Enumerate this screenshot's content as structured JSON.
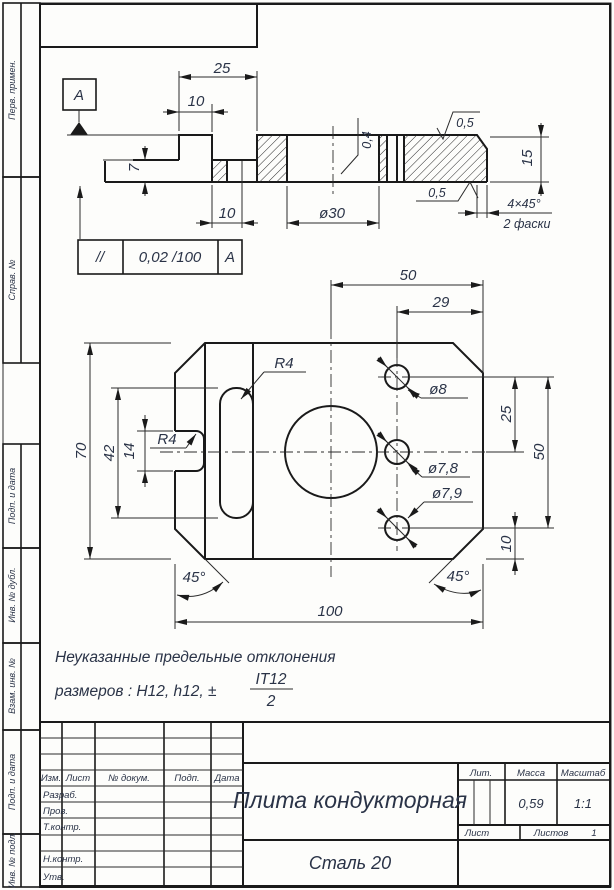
{
  "margin": {
    "labels": {
      "b1": "Перв. примен.",
      "b2": "Справ. №",
      "b3": "Подп. и дата",
      "b4": "Инв. № дубл.",
      "b5": "Взам. инв. №",
      "b6": "Подп. и дата",
      "b7": "Инв. № подл."
    }
  },
  "section": {
    "datum": "А",
    "dim25": "25",
    "dim10top": "10",
    "dim7": "7",
    "dim10bot": "10",
    "dia30": "ø30",
    "rough04": "0,4",
    "rough05top": "0,5",
    "rough05bot": "0,5",
    "dim15": "15",
    "chamfer": "4×45°",
    "chamfer_note": "2 фаски"
  },
  "tolerance": {
    "symbol": "//",
    "value": "0,02 /100",
    "datum": "А"
  },
  "plan": {
    "dim50top": "50",
    "dim29": "29",
    "dim70": "70",
    "dim42": "42",
    "dim14": "14",
    "dim100": "100",
    "dim25": "25",
    "dim50right": "50",
    "dim10": "10",
    "r4_slot": "R4",
    "r4_notch": "R4",
    "dia8": "ø8",
    "dia78": "ø7,8",
    "dia79": "ø7,9",
    "angle_left": "45°",
    "angle_right": "45°"
  },
  "note": {
    "line1": "Неуказанные предельные отклонения",
    "line2": "размеров : H12, h12, ±",
    "frac_num": "IT12",
    "frac_den": "2"
  },
  "title_block": {
    "header": {
      "izm": "Изм.",
      "list": "Лист",
      "doc": "№ докум.",
      "podp": "Подп.",
      "date": "Дата"
    },
    "rows": {
      "razrab": "Разраб.",
      "prov": "Пров.",
      "tkontr": "Т.контр.",
      "nkontr": "Н.контр.",
      "utv": "Утв."
    },
    "title": "Плита кондукторная",
    "material": "Сталь 20",
    "lit_label": "Лит.",
    "mass_label": "Масса",
    "scale_label": "Масштаб",
    "mass_value": "0,59",
    "scale_value": "1:1",
    "sheet_label": "Лист",
    "sheets_label": "Листов",
    "sheets_value": "1"
  }
}
